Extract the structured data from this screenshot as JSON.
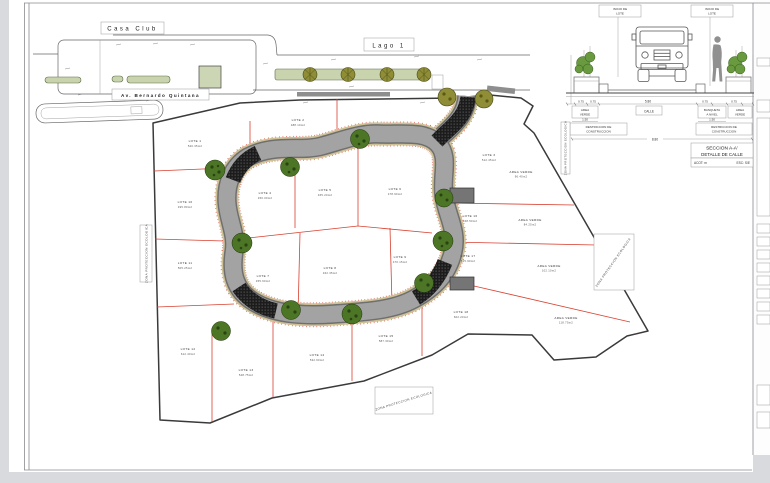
{
  "plan": {
    "labels": {
      "casa_club": "Casa Club",
      "avenue": "Av. Bernardo Quintana",
      "lake": "Lago 1",
      "eco_left": "ZONA PROTECCION ECOLOGICA",
      "eco_bottom": "ZONA PROTECCION ECOLOGICA",
      "eco_right": "ZONA PROTECCION ECOLOGICA",
      "eco_section": "ZONA PROTECCION ECOLOGICA"
    },
    "lots": [
      {
        "name": "LOTE 1",
        "area": "520.35m2",
        "x": 195,
        "y": 142
      },
      {
        "name": "LOTE 2",
        "area": "488.10m2",
        "x": 298,
        "y": 121
      },
      {
        "name": "LOTE 3",
        "area": "512.45m2",
        "x": 489,
        "y": 156
      },
      {
        "name": "LOTE 4",
        "area": "450.00m2",
        "x": 265,
        "y": 194
      },
      {
        "name": "LOTE 5",
        "area": "465.20m2",
        "x": 325,
        "y": 191
      },
      {
        "name": "LOTE 6",
        "area": "478.90m2",
        "x": 395,
        "y": 190
      },
      {
        "name": "LOTE 7",
        "area": "455.60m2",
        "x": 263,
        "y": 277
      },
      {
        "name": "LOTE 8",
        "area": "462.35m2",
        "x": 330,
        "y": 269
      },
      {
        "name": "LOTE 9",
        "area": "470.15m2",
        "x": 400,
        "y": 258
      },
      {
        "name": "LOTE 10",
        "area": "495.80m2",
        "x": 185,
        "y": 203
      },
      {
        "name": "LOTE 11",
        "area": "505.25m2",
        "x": 185,
        "y": 264
      },
      {
        "name": "LOTE 12",
        "area": "612.40m2",
        "x": 188,
        "y": 350
      },
      {
        "name": "LOTE 13",
        "area": "548.75m2",
        "x": 246,
        "y": 371
      },
      {
        "name": "LOTE 14",
        "area": "532.60m2",
        "x": 317,
        "y": 356
      },
      {
        "name": "LOTE 15",
        "area": "587.30m2",
        "x": 386,
        "y": 337
      },
      {
        "name": "LOTE 16",
        "area": "468.50m2",
        "x": 470,
        "y": 217
      },
      {
        "name": "LOTE 17",
        "area": "515.90m2",
        "x": 468,
        "y": 257
      },
      {
        "name": "LOTE 18",
        "area": "602.20m2",
        "x": 461,
        "y": 313
      }
    ],
    "green_areas": [
      {
        "name": "AREA VERDE",
        "area": "96.40m2",
        "x": 521,
        "y": 173
      },
      {
        "name": "AREA VERDE",
        "area": "84.25m2",
        "x": 530,
        "y": 221
      },
      {
        "name": "AREA VERDE",
        "area": "102.10m2",
        "x": 549,
        "y": 267
      },
      {
        "name": "AREA VERDE",
        "area": "118.75m2",
        "x": 566,
        "y": 319
      }
    ]
  },
  "section": {
    "inicio_l1": "INICIO DE",
    "inicio_l2": "LOTE",
    "labels": {
      "area_verde_l1": "AREA",
      "area_verde_l2": "VERDE",
      "calle": "CALLE",
      "banqueta_l1": "BANQUETA",
      "banqueta_l2": "A NIVEL",
      "restriccion_l1": "RESTRICCION DE",
      "restriccion_l2": "CONSTRUCCION"
    },
    "dims": {
      "verde_a": "0.75",
      "verde_b": "0.75",
      "calle": "5.80",
      "banq_a": "0.75",
      "banq_b": "0.75",
      "restr": "1.50",
      "total": "8.80"
    },
    "title": {
      "line1": "SECCION A-A'",
      "line2": "DETALLE DE CALLE",
      "acot": "ACOT: m",
      "esc": "ESC: S/E"
    }
  },
  "colors": {
    "road": "#a3a3a3",
    "casing": "#cfc196",
    "red": "#d8402f",
    "tree": "#4c7526",
    "median": "#c9d4ae",
    "hatch": "#1c1c1c",
    "boundary": "#3a3a3a",
    "olive": "#8f8d35"
  }
}
